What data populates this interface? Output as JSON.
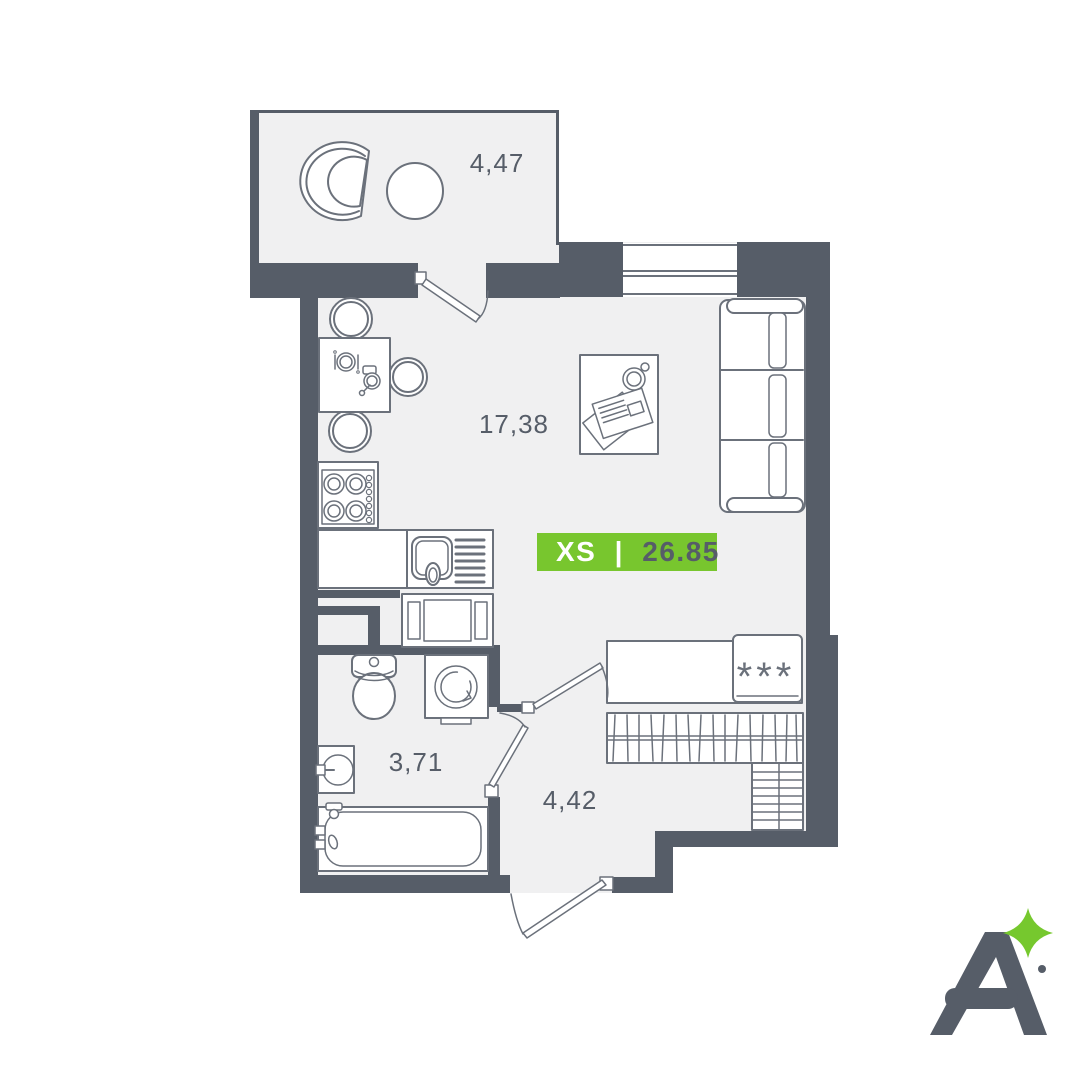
{
  "title": "Studio apartment floor plan",
  "rooms": {
    "balcony": {
      "label": "4,47"
    },
    "living_kitchen": {
      "label": "17,38"
    },
    "bathroom": {
      "label": "3,71"
    },
    "hallway": {
      "label": "4,42"
    }
  },
  "badge": {
    "size_label": "XS",
    "separator": "|",
    "area_value": "26.85"
  },
  "hallway_features": {
    "fridge_symbol": "***"
  },
  "colors": {
    "wall": "#565d68",
    "floor": "#f0f0f1",
    "furniture_outline": "#6b717b",
    "accent_green": "#78c62e",
    "label_text": "#565d68",
    "badge_size_text": "#ffffff",
    "badge_area_text": "#565d68"
  },
  "icons": [
    "armchair-icon",
    "round-table-icon",
    "dining-table-icon",
    "chair-icon",
    "stove-icon",
    "kitchen-sink-icon",
    "microwave-icon",
    "coffee-table-icon",
    "cup-icon",
    "magazine-icon",
    "sofa-icon",
    "window-icon",
    "door-icon",
    "fridge-icon",
    "snowflake-icon",
    "wardrobe-icon",
    "shelf-icon",
    "toilet-icon",
    "washing-machine-icon",
    "washbasin-icon",
    "bathtub-icon",
    "logo-letter-a",
    "sparkle-icon"
  ]
}
